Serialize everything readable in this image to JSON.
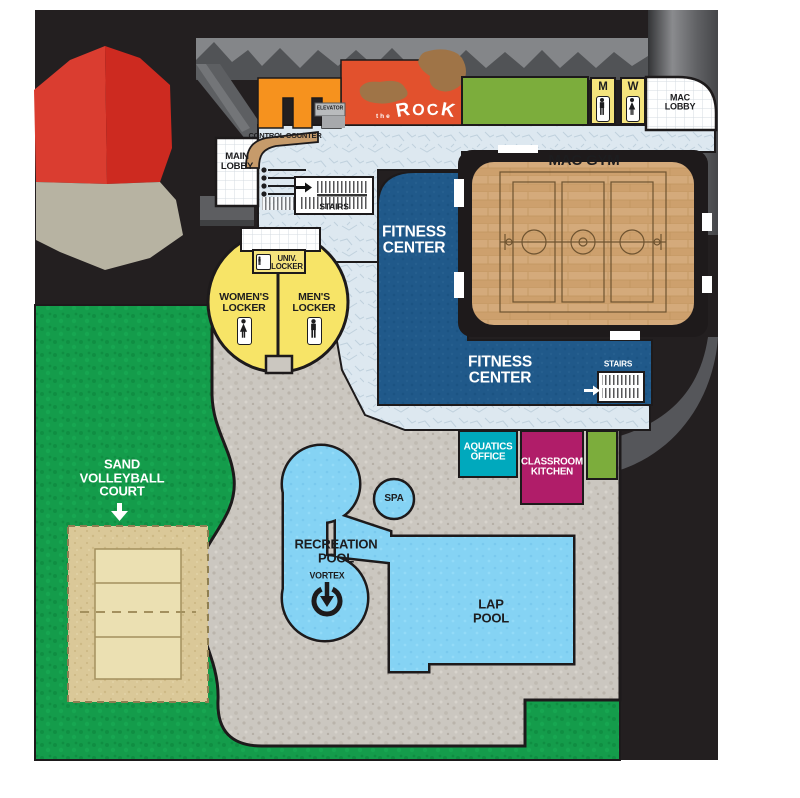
{
  "labels": {
    "main_lobby": "MAIN\nLOBBY",
    "control_counter": "CONTROL COUNTER",
    "elevator": "ELEVATOR",
    "rock_the": "the",
    "rock_letters": [
      "R",
      "O",
      "C",
      "K"
    ],
    "stairs_upper": "STAIRS",
    "stairs_lower": "STAIRS",
    "mac_gym": "MAC GYM",
    "mac_lobby": "MAC\nLOBBY",
    "restroom_men": "M",
    "restroom_women": "W",
    "fitness_center_upper": "FITNESS\nCENTER",
    "fitness_center_lower": "FITNESS\nCENTER",
    "univ_locker": "UNIV.\nLOCKER",
    "womens_locker": "WOMEN'S\nLOCKER",
    "mens_locker": "MEN'S\nLOCKER",
    "aquatics_office": "AQUATICS\nOFFICE",
    "classroom_kitchen": "CLASSROOM\nKITCHEN",
    "spa": "SPA",
    "recreation_pool": "RECREATION\nPOOL",
    "vortex": "VORTEX",
    "lap_pool": "LAP\nPOOL",
    "sand_volleyball": "SAND\nVOLLEYBALL\nCOURT"
  },
  "colors": {
    "backdrop_black": "#231f20",
    "wall_gray": "#515356",
    "grass_green": "#149c4b",
    "pool_deck_gray": "#cbc7c0",
    "corridor_blue": "#dde8f0",
    "fitness_blue": "#20598a",
    "gym_wood": "#d4aa7b",
    "locker_yellow": "#f7e467",
    "climb_orange": "#f6921e",
    "rock_sign_red": "#e2512d",
    "rock_brown": "#9f7447",
    "accent_green": "#7cad3c",
    "aquatics_teal": "#00a9bd",
    "classroom_magenta": "#b01d69",
    "pool_blue": "#85d3f4",
    "sand_tan": "#dac898",
    "rock3d_red": "#d23128",
    "rock3d_gray": "#b7b3a2"
  }
}
